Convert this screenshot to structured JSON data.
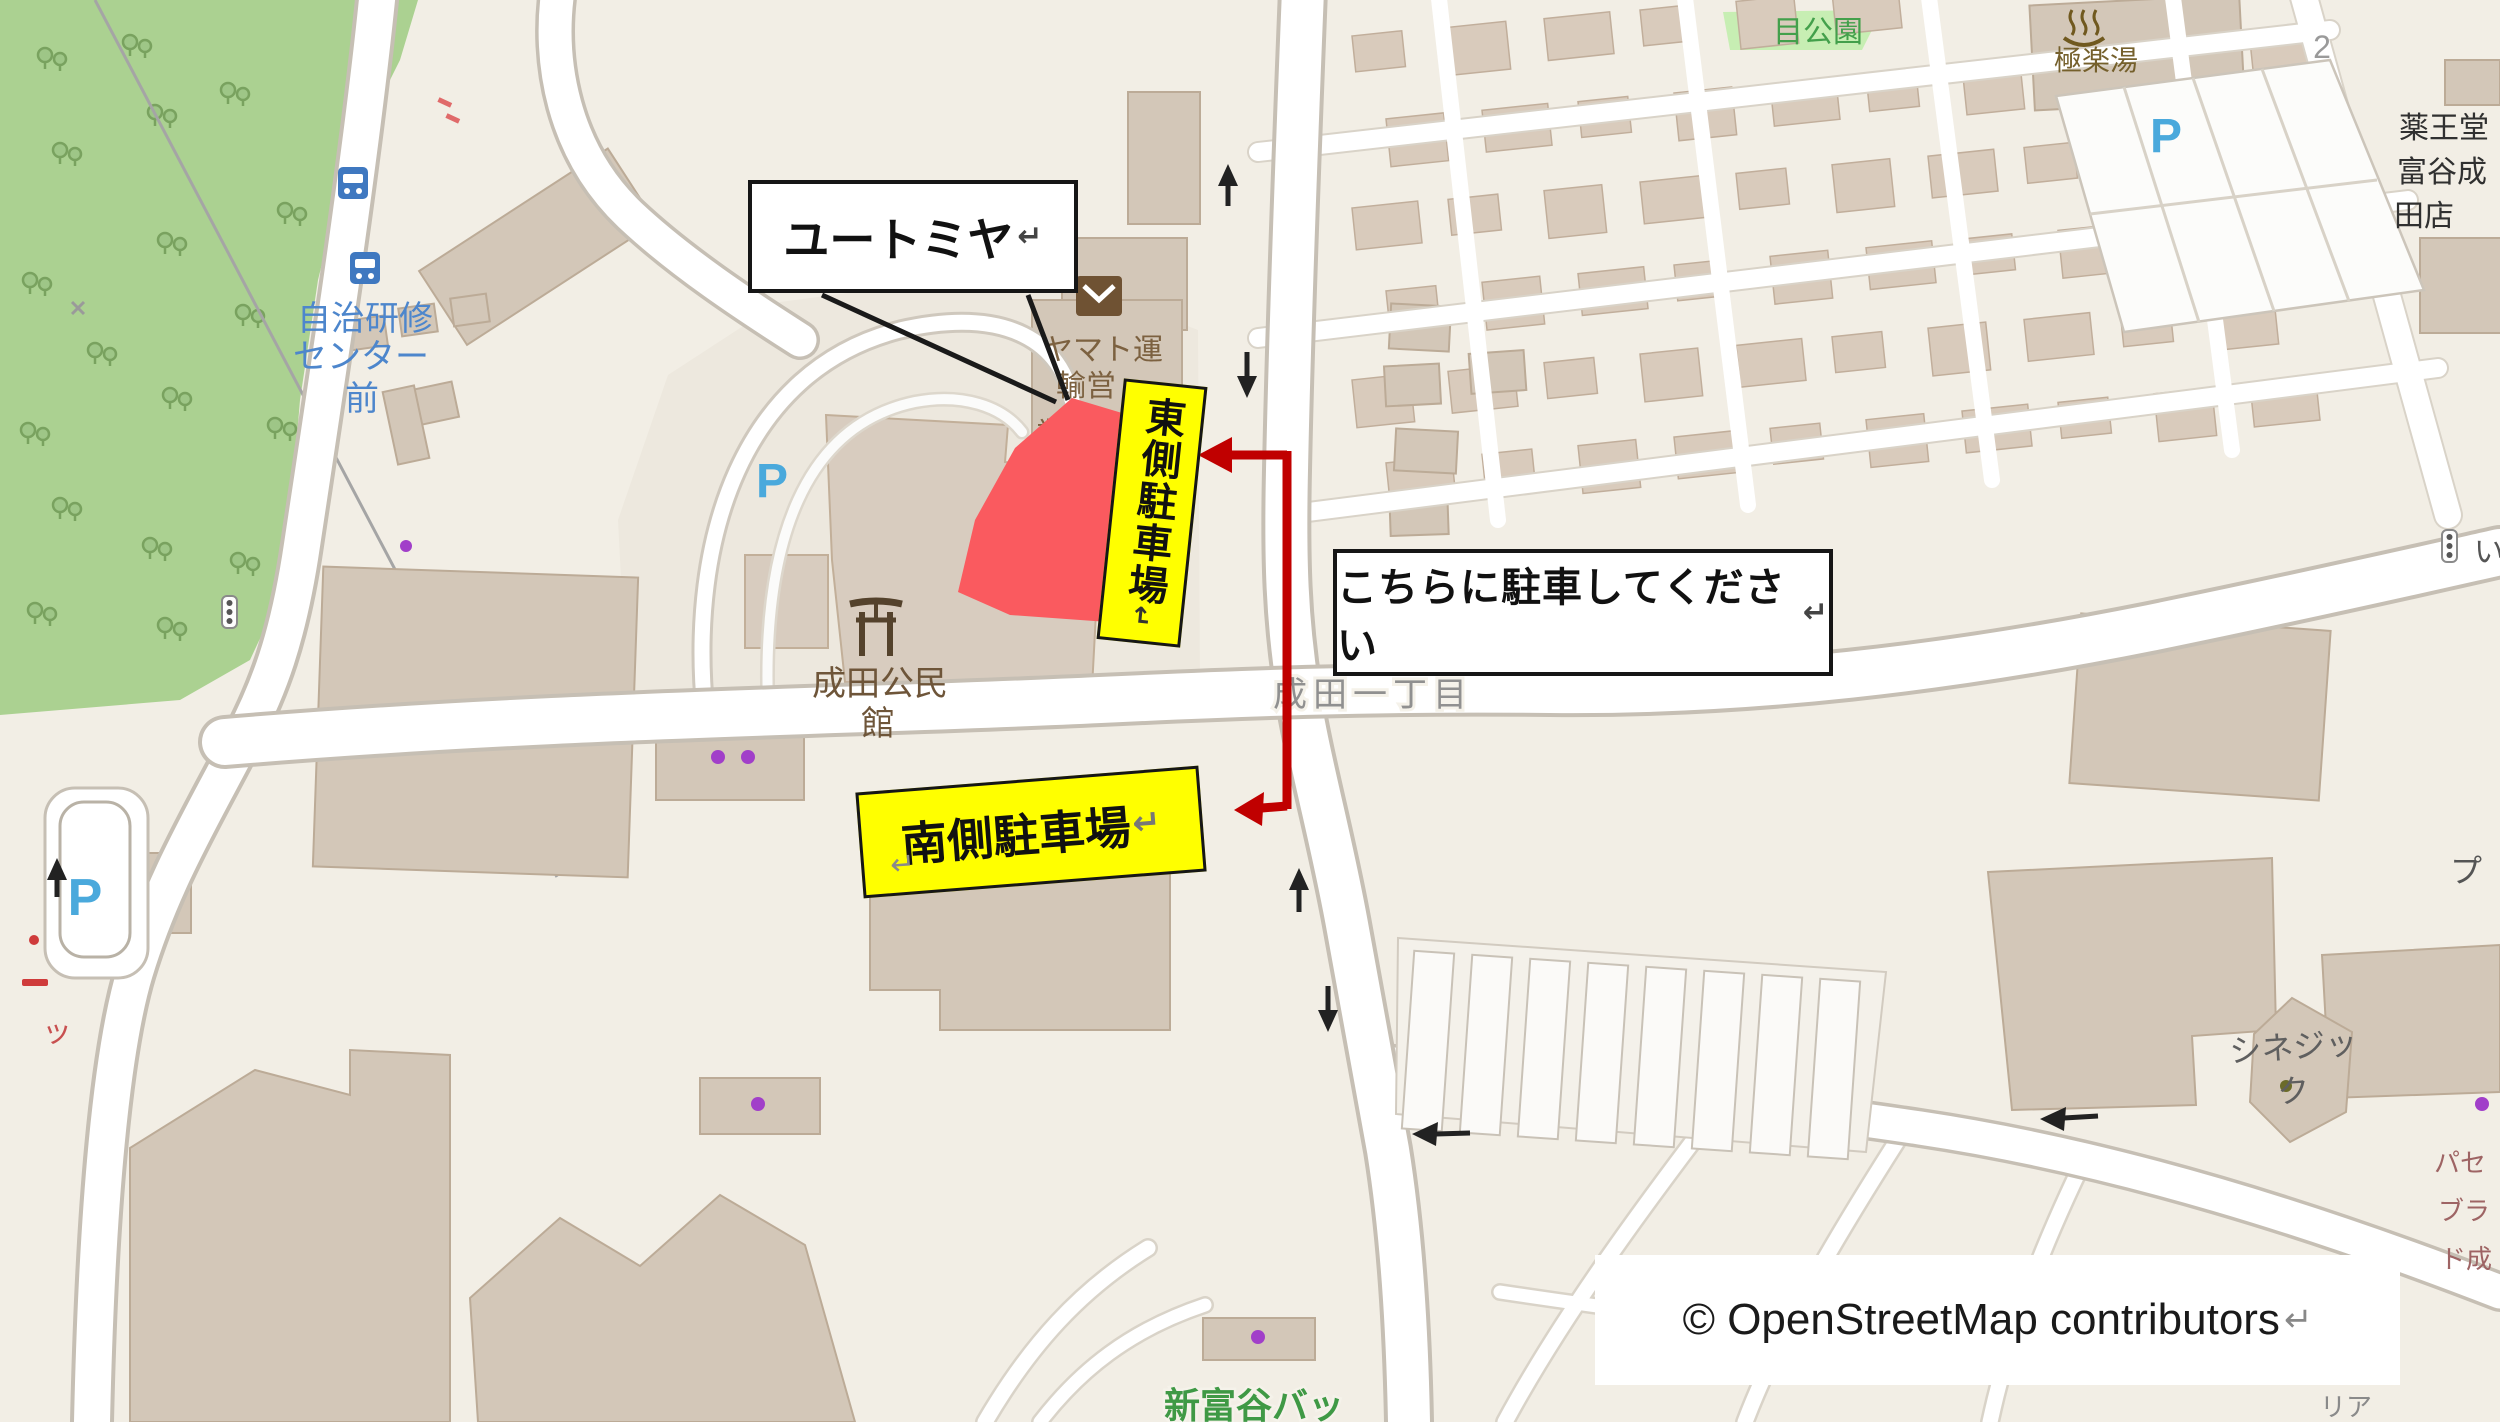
{
  "annotations": {
    "yutomiya_callout": "ユートミヤ",
    "east_parking_label": "東側駐車場",
    "south_parking_label": "南側駐車場",
    "park_here_instruction": "こちらに駐車してください",
    "attribution": "© OpenStreetMap contributors",
    "return_mark": "↵"
  },
  "map_labels": {
    "bus_stop_l1": "自治研修",
    "bus_stop_l2": "センター",
    "bus_stop_l3": "前",
    "park_green": "目公園",
    "onsen": "極楽湯",
    "house_number": "2",
    "yakuodo_l1": "薬王堂",
    "yakuodo_l2": "富谷成",
    "yakuodo_l3": "田店",
    "yamato_l1": "ヤマト運",
    "yamato_l2": "輸営",
    "yamato_l3": "業所",
    "community_l1": "成田公民",
    "community_l2": "館",
    "district_road": "成田一丁目",
    "cinegic_l1": "シネジッ",
    "cinegic_l2": "ク",
    "batting": "新富谷バッ",
    "parking_p": "P",
    "frag_tsu": "ッ",
    "frag_i": "い",
    "frag_pu": "プ",
    "frag_pase": "パセ",
    "frag_bura": "ブラ",
    "frag_donari": "ド成",
    "frag_ria": "リア"
  },
  "colors": {
    "highlight_red": "#fa5a5f",
    "arrow_red": "#c00000",
    "label_yellow": "#ffff00",
    "park_green": "#abd191"
  }
}
